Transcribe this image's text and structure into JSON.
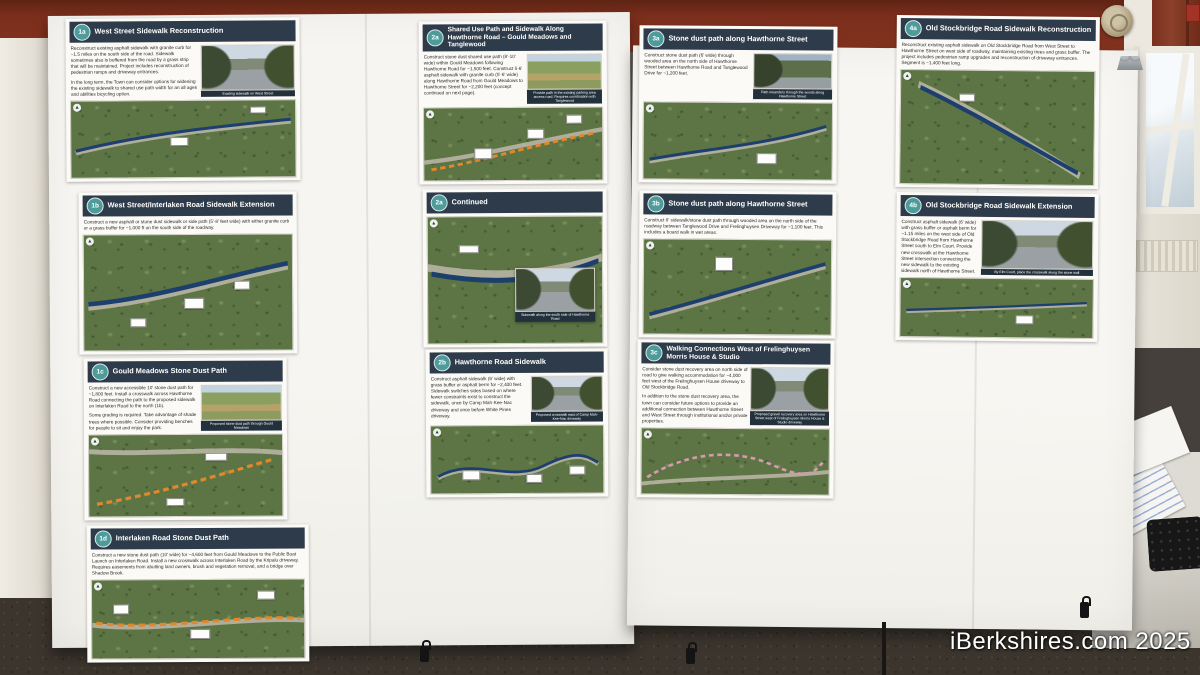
{
  "scene": {
    "watermark": "iBerkshires.com 2025"
  },
  "icons": {
    "north": "▲"
  },
  "colors": {
    "header_bar": "#2d3b4a",
    "badge_teal": "#4d9b9b",
    "wall_maroon": "#7b2e1c",
    "route_blue": "#1d3f6e",
    "route_orange": "#e0882a",
    "route_pink": "#d898b2"
  },
  "posters": [
    {
      "id": "1a",
      "badge": "1a",
      "title": "West Street Sidewalk Reconstruction",
      "body": "Reconstruct existing asphalt sidewalk with granite curb for ~1.5 miles on the south side of the road. Sidewalk sometimes also is buffered from the road by a grass strip that will be maintained. Project includes reconstruction of pedestrian ramps and driveway entrances.",
      "body2": "In the long term, the Town can consider options for widening the existing sidewalk to shared use path width for an all ages and abilities bicycling option.",
      "photo_caption": "Existing sidewalk on West Street"
    },
    {
      "id": "1b",
      "badge": "1b",
      "title": "West Street/Interlaken Road Sidewalk Extension",
      "body": "Construct a new asphalt or stone dust sidewalk or side path (5'-8' feet wide) with either granite curb or a grass buffer for ~1,000 ft on the south side of the roadway."
    },
    {
      "id": "1c",
      "badge": "1c",
      "title": "Gould Meadows Stone Dust Path",
      "body": "Construct a new accessible 10' stone dust path for ~1,800 feet. Install a crosswalk across Hawthorne Road connecting the path to the proposed sidewalk on Interlaken Road to the north (1b).",
      "body2": "Some grading is required. Take advantage of shade trees where possible. Consider providing benches for people to sit and enjoy the park.",
      "photo_caption": "Proposed stone dust path through Gould Meadows"
    },
    {
      "id": "1d",
      "badge": "1d",
      "title": "Interlaken Road Stone Dust Path",
      "body": "Construct a new stone dust path (10' wide) for ~4,600 feet from Gould Meadows to the Public Boat Launch on Interlaken Road. Install a new crosswalk across Interlaken Road by the Kripalu driveway. Requires easements from abutting land owners, brush and vegetation removal, and a bridge over Shadow Brook."
    },
    {
      "id": "2a",
      "badge": "2a",
      "title": "Shared Use Path and Sidewalk Along Hawthorne Road – Gould Meadows and Tanglewood",
      "body": "Construct stone dust shared use path (8'-10' wide) within Gould Meadows following Hawthorne Road for ~1,500 feet. Construct 5-6' asphalt sidewalk with granite curb (5'-6' wide) along Hawthorne Road from Gould Meadows to Hawthorne Street for ~2,200 feet (concept continued on next page).",
      "photo_caption": "Provide path in the existing parking area access road. Requires coordination with Tanglewood"
    },
    {
      "id": "2a-continued",
      "badge": "2a",
      "title": "Continued",
      "photo_caption": "Sidewalk along the south side of Hawthorne Road"
    },
    {
      "id": "2b",
      "badge": "2b",
      "title": "Hawthorne Road Sidewalk",
      "body": "Construct asphalt sidewalk (6' wide) with grass buffer or asphalt berm for ~2,400 feet. Sidewalk switches sides based on where fewer constraints exist to construct the sidewalk, once by Camp Mah-Kee-Nac driveway and once before White Pines driveway.",
      "photo_caption": "Proposed crosswalk east of Camp Mah-Kee-Nac driveway"
    },
    {
      "id": "3a",
      "badge": "3a",
      "title": "Stone dust path along Hawthorne Street",
      "body": "Construct stone dust path (6' wide) through wooded area on the north side of Hawthorne Street between Hawthorne Road and Tanglewood Drive for ~1,200 feet.",
      "photo_caption": "Path meanders through the woods along Hawthorne Street"
    },
    {
      "id": "3b",
      "badge": "3b",
      "title": "Stone dust path along Hawthorne Street",
      "body": "Construct 8' sidewalk/stone dust path through wooded area on the north side of the roadway between Tanglewood Drive and Frelinghuysen Driveway for ~1,100 feet. This includes a board walk in wet areas."
    },
    {
      "id": "3c",
      "badge": "3c",
      "title": "Walking Connections West of Frelinghuysen Morris House & Studio",
      "body": "Consider stone dust recovery area on north side of road to give walking accommodation for ~4,000 feet west of the Frelinghuysen House driveway to Old Stockbridge Road.",
      "body2": "In addition to the stone dust recovery area, the town can consider future options to provide an additional connection between Hawthorne Street and West Street through institutional and/or private properties.",
      "photo_caption": "Proposed gravel recovery area on Hawthorne Street west of Frelinghuysen Morris House & Studio driveway"
    },
    {
      "id": "4a",
      "badge": "4a",
      "title": "Old Stockbridge Road Sidewalk Reconstruction",
      "body": "Reconstruct existing asphalt sidewalk on Old Stockbridge Road from West Street to Hawthorne Street on west side of roadway, maintaining existing trees and grass buffer. The project includes pedestrian ramp upgrades and reconstruction of driveway entrances. Segment is ~1,400 feet long."
    },
    {
      "id": "4b",
      "badge": "4b",
      "title": "Old Stockbridge Road Sidewalk Extension",
      "body": "Construct asphalt sidewalk (6' wide) with grass buffer or asphalt berm for ~1.15 miles on the west side of Old Stockbridge Road from Hawthorne Street south to Elm Court. Provide new crosswalk at the Hawthorne Street intersection connecting the new sidewalk to the existing sidewalk north of Hawthorne Street.",
      "photo_caption": "By Elm Court, place the crosswalk along the stone wall"
    }
  ]
}
